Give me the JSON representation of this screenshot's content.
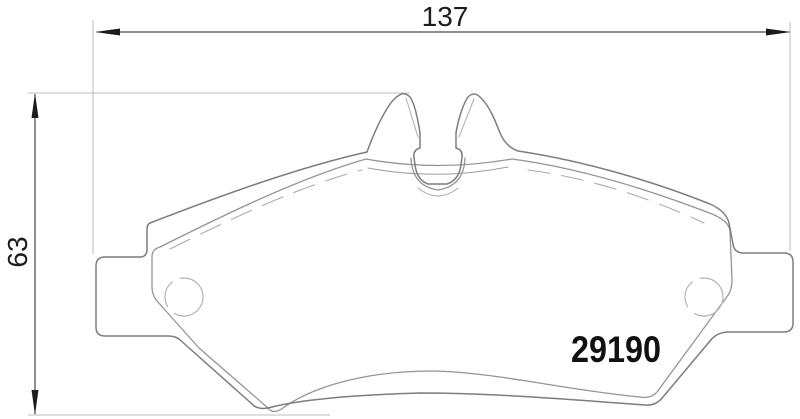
{
  "drawing": {
    "part_number": "29190",
    "dimensions": {
      "width_label": "137",
      "height_label": "63"
    },
    "colors": {
      "background": "#ffffff",
      "dimension_lines": "#1c1c1c",
      "part_outline": "#7d7d7d",
      "friction_outline": "#949494",
      "faint_lines": "#b4b4b4"
    },
    "paths": {
      "backplate": "M 150,223 C 225,194 300,167 367,152 C 376,127 389,101 398,96 Q 404,91 410,97 C 415,104 418,120 420,133 L 420,148 Q 413,150 414,157 L 415,165 Q 417,180 428,184 L 447,184 Q 459,180 461,165 L 462,157 Q 463,150 456,148 L 456,133 C 458,120 463,104 468,97 Q 474,91 480,97 C 489,105 495,120 500,133 Q 506,147 518,151 C 585,161 655,182 710,204 Q 726,211 729,223 L 733,244 Q 734,252 742,253 L 784,253 Q 793,253 793,262 L 793,323 Q 793,332 784,332 L 727,332 Q 716,333 710,341 L 663,397 Q 656,406 645,405 C 565,399 490,393 420,393 C 350,395 300,400 272,407 Q 258,411 252,404 L 179,339 Q 175,336 168,336 L 105,336 Q 96,336 96,327 L 96,266 Q 96,257 105,257 L 140,257 Q 147,257 147,249 L 147,230 Q 147,224 150,223 Z",
      "friction": "M 160,247 C 230,212 300,178 366,159 Q 437,172 512,159 C 580,168 650,190 712,214 Q 729,221 730,231 L 732,281 Q 732,291 726,298 L 657,392 Q 651,399 640,397 C 565,390 495,372 432,371 C 370,371 315,385 283,408 Q 273,415 268,408 L 199,348 L 157,301 Q 152,295 152,287 L 152,257 Q 152,249 160,247 Z",
      "chamfer_mid": "M 368,168 Q 437,181 508,167",
      "chamfer_dashed_left": "M 170,249 C 235,217 300,186 362,170",
      "chamfer_dashed_right": "M 528,170 C 590,178 650,198 704,223",
      "slot_outer_u": "M 411,158 Q 412,186 438,190 Q 464,186 465,158",
      "slot_deep_arc": "M 418,188 Q 438,204 458,188",
      "ear_left_inner": "M 406,98 L 418,137",
      "ear_right_inner": "M 474,99 L 459,137",
      "hole_left": "M 203,297 a 19,19 0 1 1 -38,0 a 19,19 0 1 1 38,0",
      "hole_right": "M 723,297 a 19,19 0 1 1 -38,0 a 19,19 0 1 1 38,0",
      "dim_width_line": "M 97,32 L 789,32",
      "dim_height_line": "M 35,94 L 35,414",
      "ext_left_vertical": "M 93,20 L 93,254",
      "ext_right_vertical": "M 790,22 L 790,251",
      "ext_top_horizontal": "M 28,93 L 410,93",
      "ext_bottom_horizontal": "M 28,415 L 330,415",
      "arrow_width_left": "M 95,32 L 120,28.5 L 120,35.5 Z",
      "arrow_width_right": "M 791,32 L 766,28.5 L 766,35.5 Z",
      "arrow_height_up": "M 35,93 L 31.5,118 L 38.5,118 Z",
      "arrow_height_down": "M 35,415 L 31.5,390 L 38.5,390 Z"
    }
  }
}
